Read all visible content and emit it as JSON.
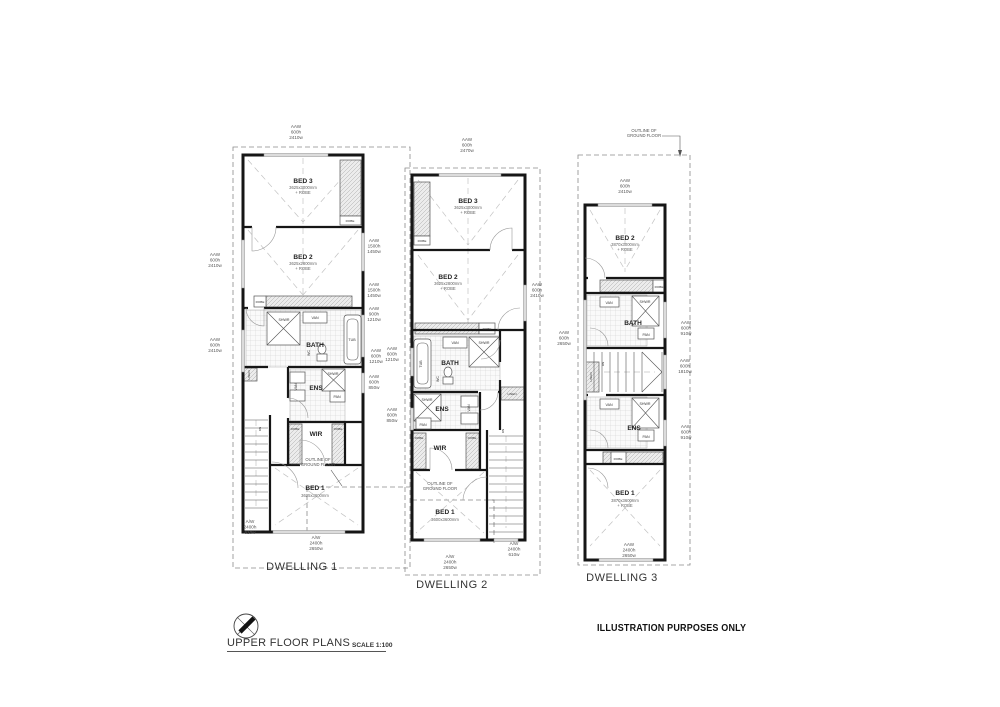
{
  "sheet": {
    "title": "UPPER FLOOR PLANS",
    "scale": "SCALE 1:100",
    "note": "ILLUSTRATION PURPOSES ONLY"
  },
  "common": {
    "outline": "OUTLINE OF\nGROUND FLOOR",
    "fx": {
      "bath": "BATH",
      "ens": "ENS",
      "wir": "WIR",
      "shwr": "SHWR",
      "van": "VAN",
      "tub": "TUB",
      "wc": "WC",
      "pan": "PAN",
      "robe": "ROBE",
      "linen": "LINEN",
      "dn": "DN"
    }
  },
  "d1": {
    "name": "DWELLING 1",
    "bed3": {
      "label": "BED 3",
      "dims": "3625x3000mm\n+ ROBE"
    },
    "bed2": {
      "label": "BED 2",
      "dims": "3625x2800mm\n+ ROBE"
    },
    "bed1": {
      "label": "BED 1",
      "dims": "3625x3600mm"
    },
    "win": {
      "top": "AAW\n600h\n2410w",
      "left1": "AAW\n600h\n2410w",
      "left2": "AAW\n600h\n2410w",
      "right1": "AAW\n1500h\n1450w",
      "right2": "AAW\n1500h\n1450w",
      "right3": "AAW\n900h\n1210w",
      "right4": "AAW\n600h\n1210w",
      "right5": "AAW\n600h\n850w",
      "botleft": "A/W\n2400h\n610w",
      "bottom": "A/W\n2400h\n2650w"
    }
  },
  "d2": {
    "name": "DWELLING 2",
    "bed3": {
      "label": "BED 3",
      "dims": "3625x3000mm\n+ ROBE"
    },
    "bed2": {
      "label": "BED 2",
      "dims": "3625x2800mm\n+ ROBE"
    },
    "bed1": {
      "label": "BED 1",
      "dims": "3600x3600mm"
    },
    "win": {
      "top": "AAW\n600h\n2470w",
      "left1": "AAW\n600h\n1210w",
      "left2": "AAW\n600h\n850w",
      "right1": "AAW\n600h\n2410w",
      "botright": "A/W\n2400h\n610w",
      "bottom": "A/W\n2400h\n2650w"
    }
  },
  "d3": {
    "name": "DWELLING 3",
    "bed2": {
      "label": "BED 2",
      "dims": "3870x3000mm\n+ ROBE"
    },
    "bed1": {
      "label": "BED 1",
      "dims": "3870x3600mm\n+ ROBE"
    },
    "win": {
      "top": "AAW\n600h\n2410w",
      "left1": "AAW\n600h\n2650w",
      "right1": "AAW\n600h\n910w",
      "right2": "AAW\n600h\n1810w",
      "right3": "AAW\n600h\n910w",
      "bottom": "AAW\n2400h\n2650w"
    }
  }
}
